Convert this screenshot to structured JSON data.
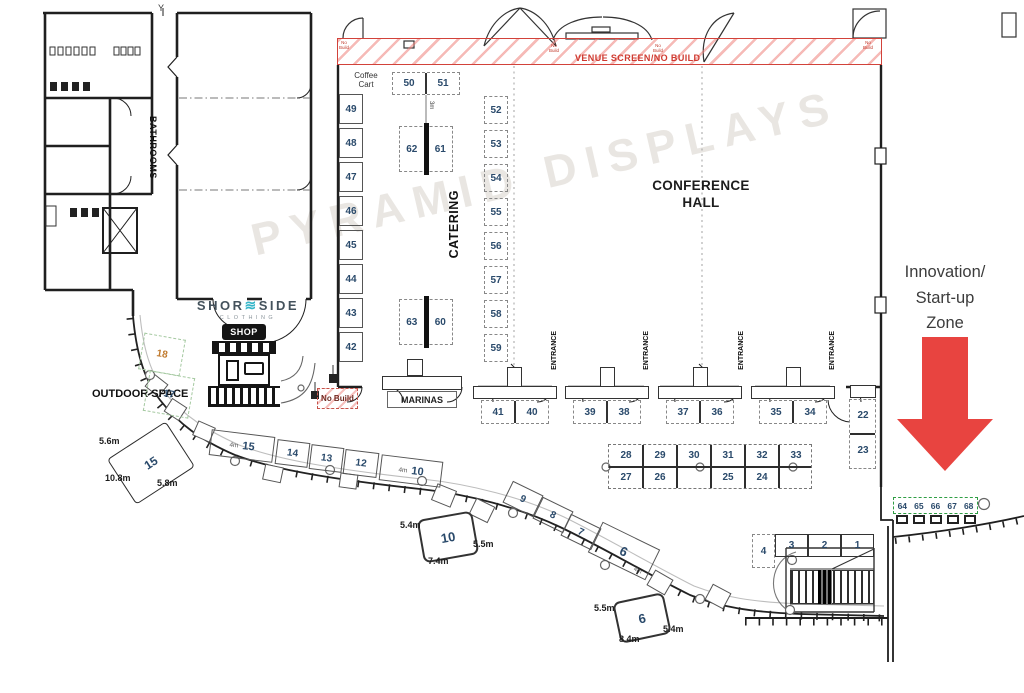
{
  "watermark": "PYRAMID DISPLAYS",
  "colors": {
    "arrow_red": "#e84440",
    "hatch_red": "#ee827c",
    "band_border_red": "#d2423a",
    "startup_green": "#2f9e44",
    "outdoor_green": "#a5c9a1",
    "booth_number_navy": "#2a4a6b",
    "booth18_orange": "#c07a2e",
    "wall_black": "#1f1f1f"
  },
  "labels": {
    "y_grid": "Y",
    "bathrooms": "BATHROOMS",
    "catering": "CATERING",
    "conference_1": "CONFERENCE",
    "conference_2": "HALL",
    "venue_screen": "VENUE SCREEN/NO BUILD",
    "coffee_1": "Coffee",
    "coffee_2": "Cart",
    "no_build": "No Build",
    "marinas": "MARINAS",
    "outdoor_space": "OUTDOOR SPACE",
    "entrance": "ENTRANCE",
    "shop": "SHOP",
    "brand_pre": "SHOR",
    "brand_wave": "≋",
    "brand_post": "SIDE",
    "brand_sub": "CLOTHING",
    "innovation_1": "Innovation/",
    "innovation_2": "Start-up",
    "innovation_3": "Zone",
    "three_m": "3m",
    "four_m": "4m"
  },
  "booths": {
    "top_pair": [
      "50",
      "51"
    ],
    "catering_left": [
      "49",
      "48",
      "47",
      "46",
      "45",
      "44",
      "43",
      "42"
    ],
    "mid_top": [
      "62",
      "61"
    ],
    "mid_bottom": [
      "63",
      "60"
    ],
    "right_col": [
      "52",
      "53",
      "54",
      "55",
      "56",
      "57",
      "58",
      "59"
    ],
    "bottom_pairs": [
      [
        "41",
        "40"
      ],
      [
        "39",
        "38"
      ],
      [
        "37",
        "36"
      ],
      [
        "35",
        "34"
      ]
    ],
    "island_top": [
      "28",
      "29",
      "30",
      "31",
      "32",
      "33"
    ],
    "island_bottom": [
      "27",
      "26",
      "25",
      "24"
    ],
    "side_col": [
      "22",
      "23"
    ],
    "outdoor": [
      "18",
      "17"
    ],
    "curve_row": [
      "15",
      "14",
      "13",
      "12",
      "10"
    ],
    "diag_row": [
      "9",
      "8",
      "7",
      "6"
    ],
    "bottom_row": [
      "4",
      "3",
      "2",
      "1"
    ],
    "startup_strip": [
      "64",
      "65",
      "66",
      "67",
      "68"
    ]
  },
  "callouts": [
    {
      "booth": "15",
      "side_a": "5.6m",
      "side_b": "10.8m",
      "side_c": "5.8m"
    },
    {
      "booth": "10",
      "side_a": "5.4m",
      "side_b": "7.4m",
      "side_c": "5.5m"
    },
    {
      "booth": "6",
      "side_a": "5.5m",
      "side_b": "8.4m",
      "side_c": "5.4m"
    }
  ]
}
